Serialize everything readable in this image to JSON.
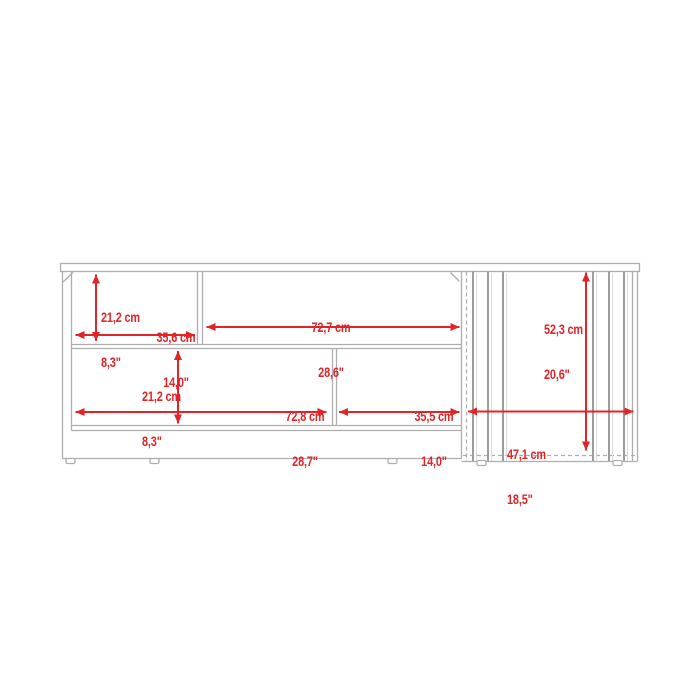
{
  "diagram": {
    "kind": "furniture-dimension-drawing",
    "accent_color": "#e02428",
    "line_color": "#aeaeae",
    "dimensions": {
      "upper_shelf_height": {
        "cm": "21,2 cm",
        "in": "8,3\""
      },
      "upper_left_shelf_width": {
        "cm": "35,6 cm",
        "in": "14,0\""
      },
      "upper_right_shelf_width": {
        "cm": "72,7 cm",
        "in": "28,6\""
      },
      "cabinet_height": {
        "cm": "52,3 cm",
        "in": "20,6\""
      },
      "lower_shelf_height": {
        "cm": "21,2 cm",
        "in": "8,3\""
      },
      "lower_left_shelf_width": {
        "cm": "72,8 cm",
        "in": "28,7\""
      },
      "lower_right_shelf_width": {
        "cm": "35,5 cm",
        "in": "14,0\""
      },
      "cabinet_width": {
        "cm": "47,1 cm",
        "in": "18,5\""
      }
    }
  }
}
